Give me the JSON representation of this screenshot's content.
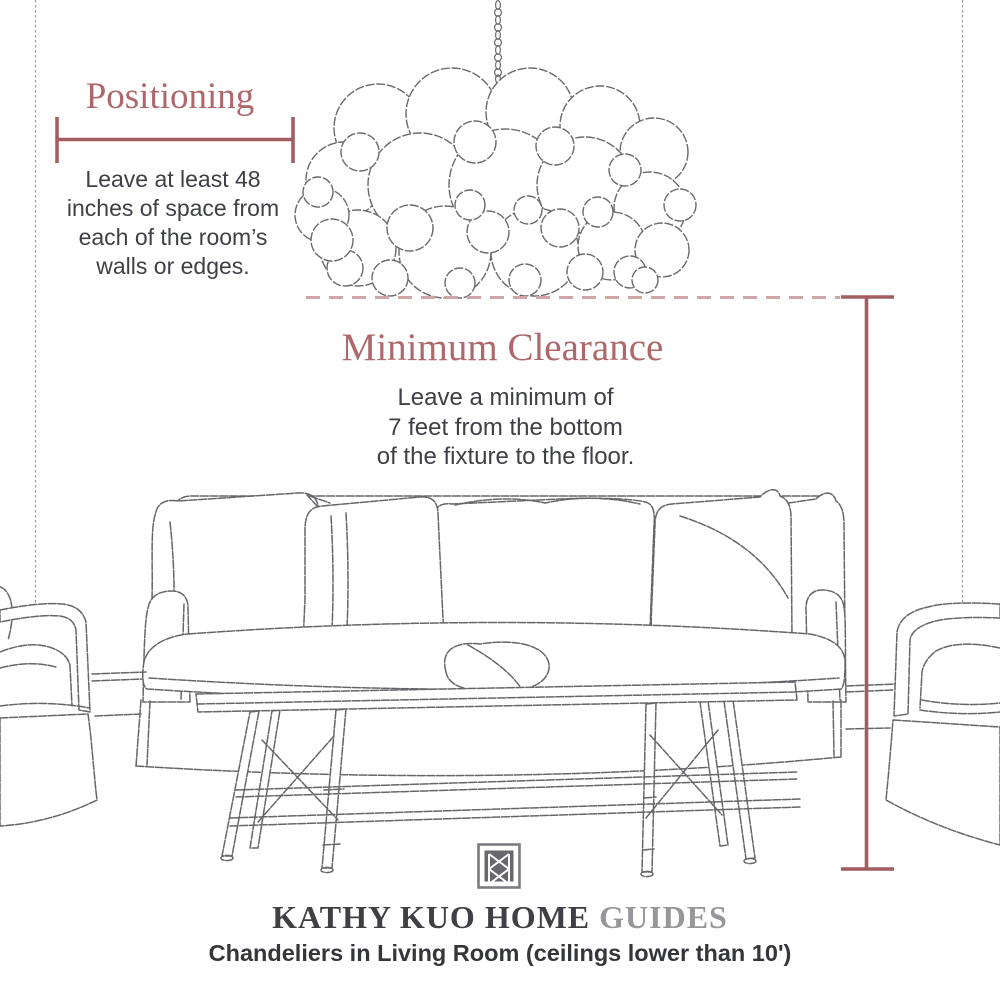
{
  "colors": {
    "background": "#ffffff",
    "heading_rose": "#ad686c",
    "measure_line_rose": "#a35d60",
    "dashed_line_pink": "#cfa6a8",
    "sketch_gray": "#66666a",
    "body_text": "#3e4046",
    "brand_dark": "#3f3f45",
    "brand_light": "#97969b",
    "logo_gray": "#67676d"
  },
  "positioning": {
    "title": "Positioning",
    "lines": [
      "Leave at least 48",
      "inches of space from",
      "each of the room’s",
      "walls or edges."
    ]
  },
  "clearance": {
    "title": "Minimum Clearance",
    "lines": [
      "Leave a minimum of",
      "7 feet from the bottom",
      "of the fixture to the floor."
    ]
  },
  "footer": {
    "brand_primary": "KATHY KUO HOME",
    "brand_secondary": "GUIDES",
    "subtitle": "Chandeliers in Living Room (ceilings lower than 10')"
  },
  "illustration": {
    "chandelier": "bubble-chandelier-sketch",
    "chain": "hanging-chain",
    "sofa": "slipcovered-sofa-sketch",
    "bench": "coffee-table-bench-sketch",
    "left_chair": "armchair-left-sketch",
    "right_chair": "armchair-right-sketch",
    "walls": "room-wall-lines",
    "logo_icon": "kathy-kuo-home-monogram"
  }
}
